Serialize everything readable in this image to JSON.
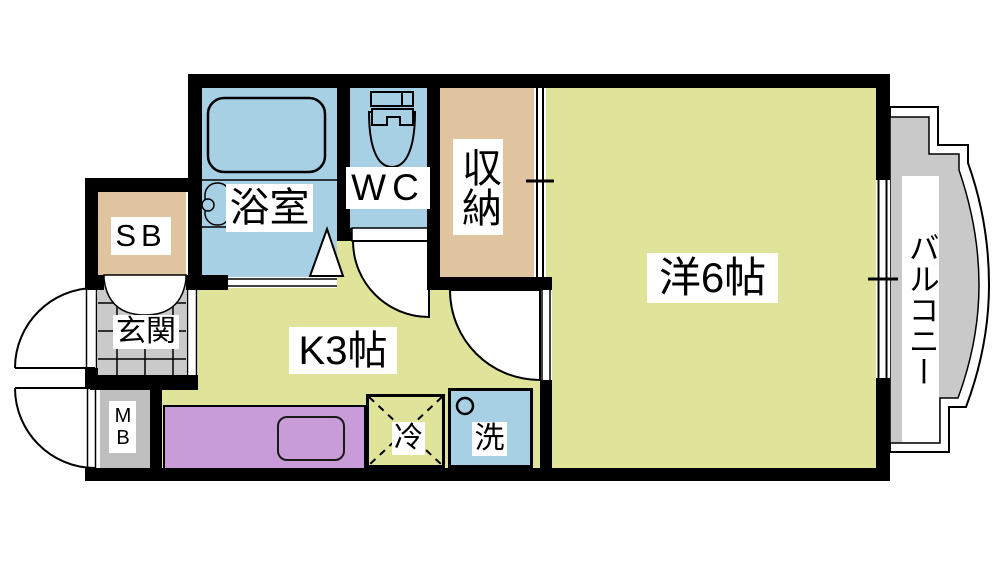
{
  "floorplan": {
    "rooms": {
      "bathroom": {
        "label": "浴室"
      },
      "toilet": {
        "label": "WC"
      },
      "storage": {
        "label": "収納"
      },
      "western_room": {
        "label": "洋6帖"
      },
      "kitchen": {
        "label": "K3帖"
      },
      "balcony": {
        "label": "バルコニー"
      },
      "entrance": {
        "label": "玄関"
      },
      "shoe_box": {
        "label": "SB"
      },
      "meter_box": {
        "label": "MB"
      },
      "refrigerator": {
        "label": "冷"
      },
      "washer": {
        "label": "洗"
      }
    },
    "colors": {
      "floor_yellow": "#dfe49a",
      "water_blue": "#a8d0e4",
      "closet_tan": "#dfc49f",
      "tile_gray": "#cacaca",
      "balcony_gray": "#c9c9c9",
      "meter_gray": "#bfbfbf",
      "counter_purple": "#c89cd9",
      "wall_black": "#000000"
    }
  }
}
